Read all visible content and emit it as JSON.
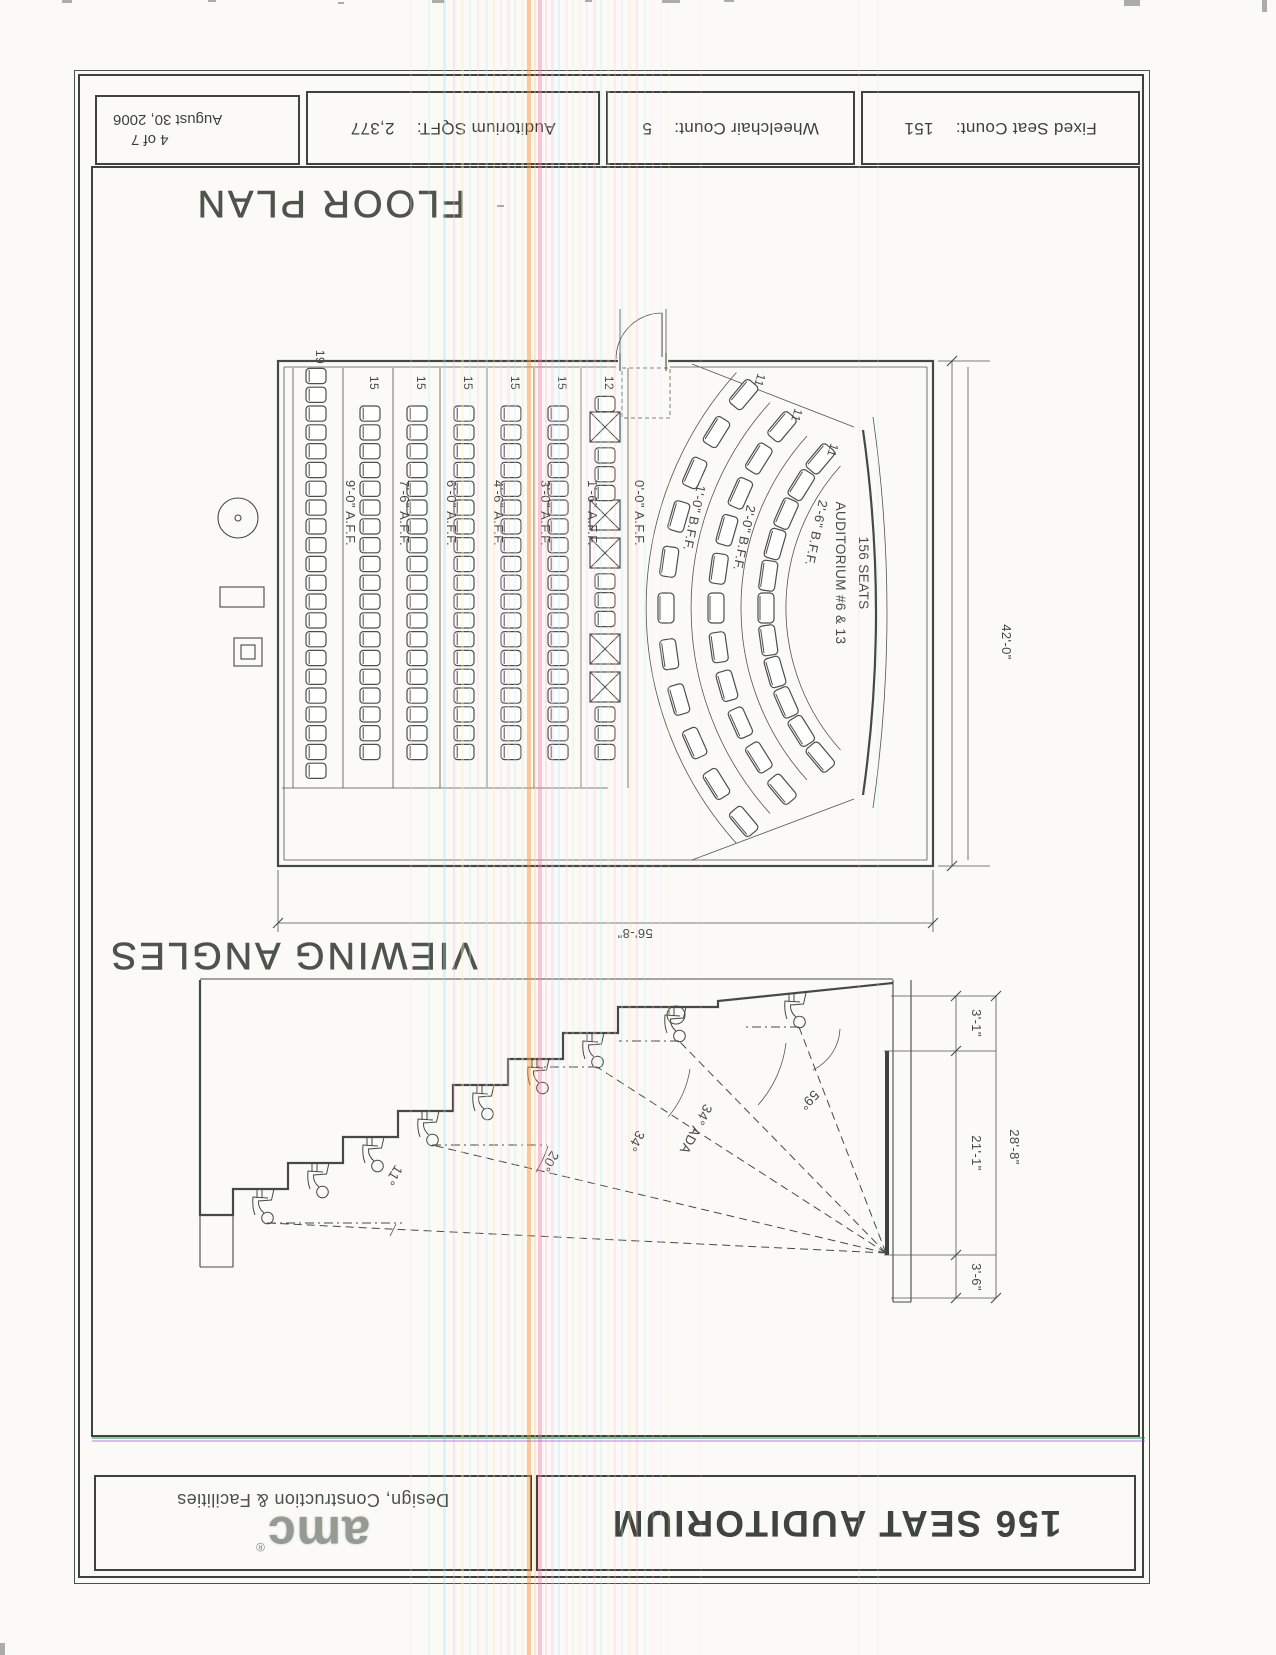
{
  "sheet": {
    "info_bar": {
      "fixed_label": "Fixed Seat Count:",
      "fixed_value": "151",
      "wheelchair_label": "Wheelchair Count:",
      "wheelchair_value": "5",
      "sqft_label": "Auditorium SQFT:",
      "sqft_value": "2,377",
      "sheet_number": "4 of 7",
      "date": "August 30, 2006"
    },
    "title_block": {
      "title": "156 SEAT AUDITORIUM",
      "brand": "amc",
      "registered": "®",
      "department": "Design, Construction & Facilities"
    },
    "floor_plan": {
      "title": "FLOOR PLAN",
      "auditorium_line1": "AUDITORIUM #6 & 13",
      "auditorium_line2": "156 SEATS",
      "width_dim": "56'-8\"",
      "depth_dim": "42'-0\"",
      "straight_rows": [
        {
          "label": "0'-0\" A.F.F.",
          "count": "12"
        },
        {
          "label": "1'-6\" A.F.F.",
          "count": "15"
        },
        {
          "label": "3'-0\" A.F.F.",
          "count": "15"
        },
        {
          "label": "4'-6\" A.F.F.",
          "count": "15"
        },
        {
          "label": "6'-0\" A.F.F.",
          "count": "15"
        },
        {
          "label": "7'-6\" A.F.F.",
          "count": "15"
        },
        {
          "label": "9'-0\" A.F.F.",
          "count": "19"
        }
      ],
      "curved_rows": [
        {
          "label": "1'-0\" B.F.F.",
          "count": "11"
        },
        {
          "label": "2'-0\" B.F.F.",
          "count": "11"
        },
        {
          "label": "2'-6\" B.F.F.",
          "count": "11"
        }
      ]
    },
    "viewing_angles": {
      "title": "VIEWING ANGLES",
      "angle_front": "59°",
      "angle_ada": "34° ADA",
      "angle_row1": "34°",
      "angle_mid": "20°",
      "angle_back": "11°",
      "dim_above_screen": "3'-6\"",
      "dim_screen": "21'-1\"",
      "dim_below_screen": "3'-1\"",
      "dim_overall": "28'-8\""
    }
  }
}
